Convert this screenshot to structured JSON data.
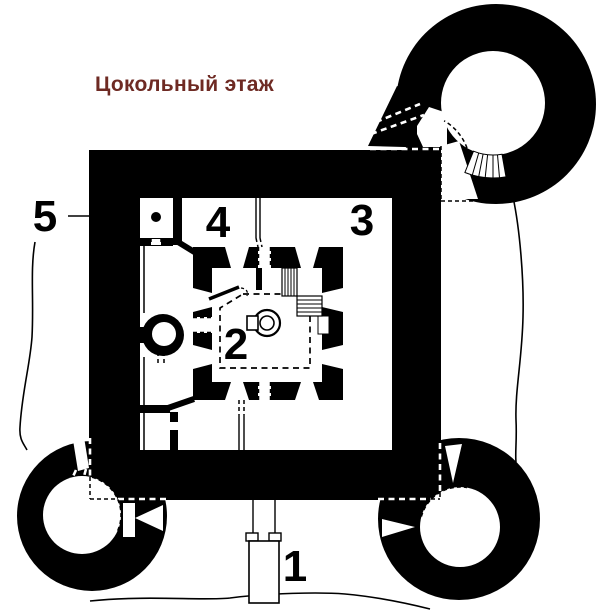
{
  "title": "Цокольный этаж",
  "colors": {
    "title": "#6e2a23",
    "ink": "#000000",
    "paper": "#ffffff"
  },
  "labels": {
    "entrance": "1",
    "central_chamber": "2",
    "east_room": "3",
    "north_room": "4",
    "outer_wall": "5"
  }
}
